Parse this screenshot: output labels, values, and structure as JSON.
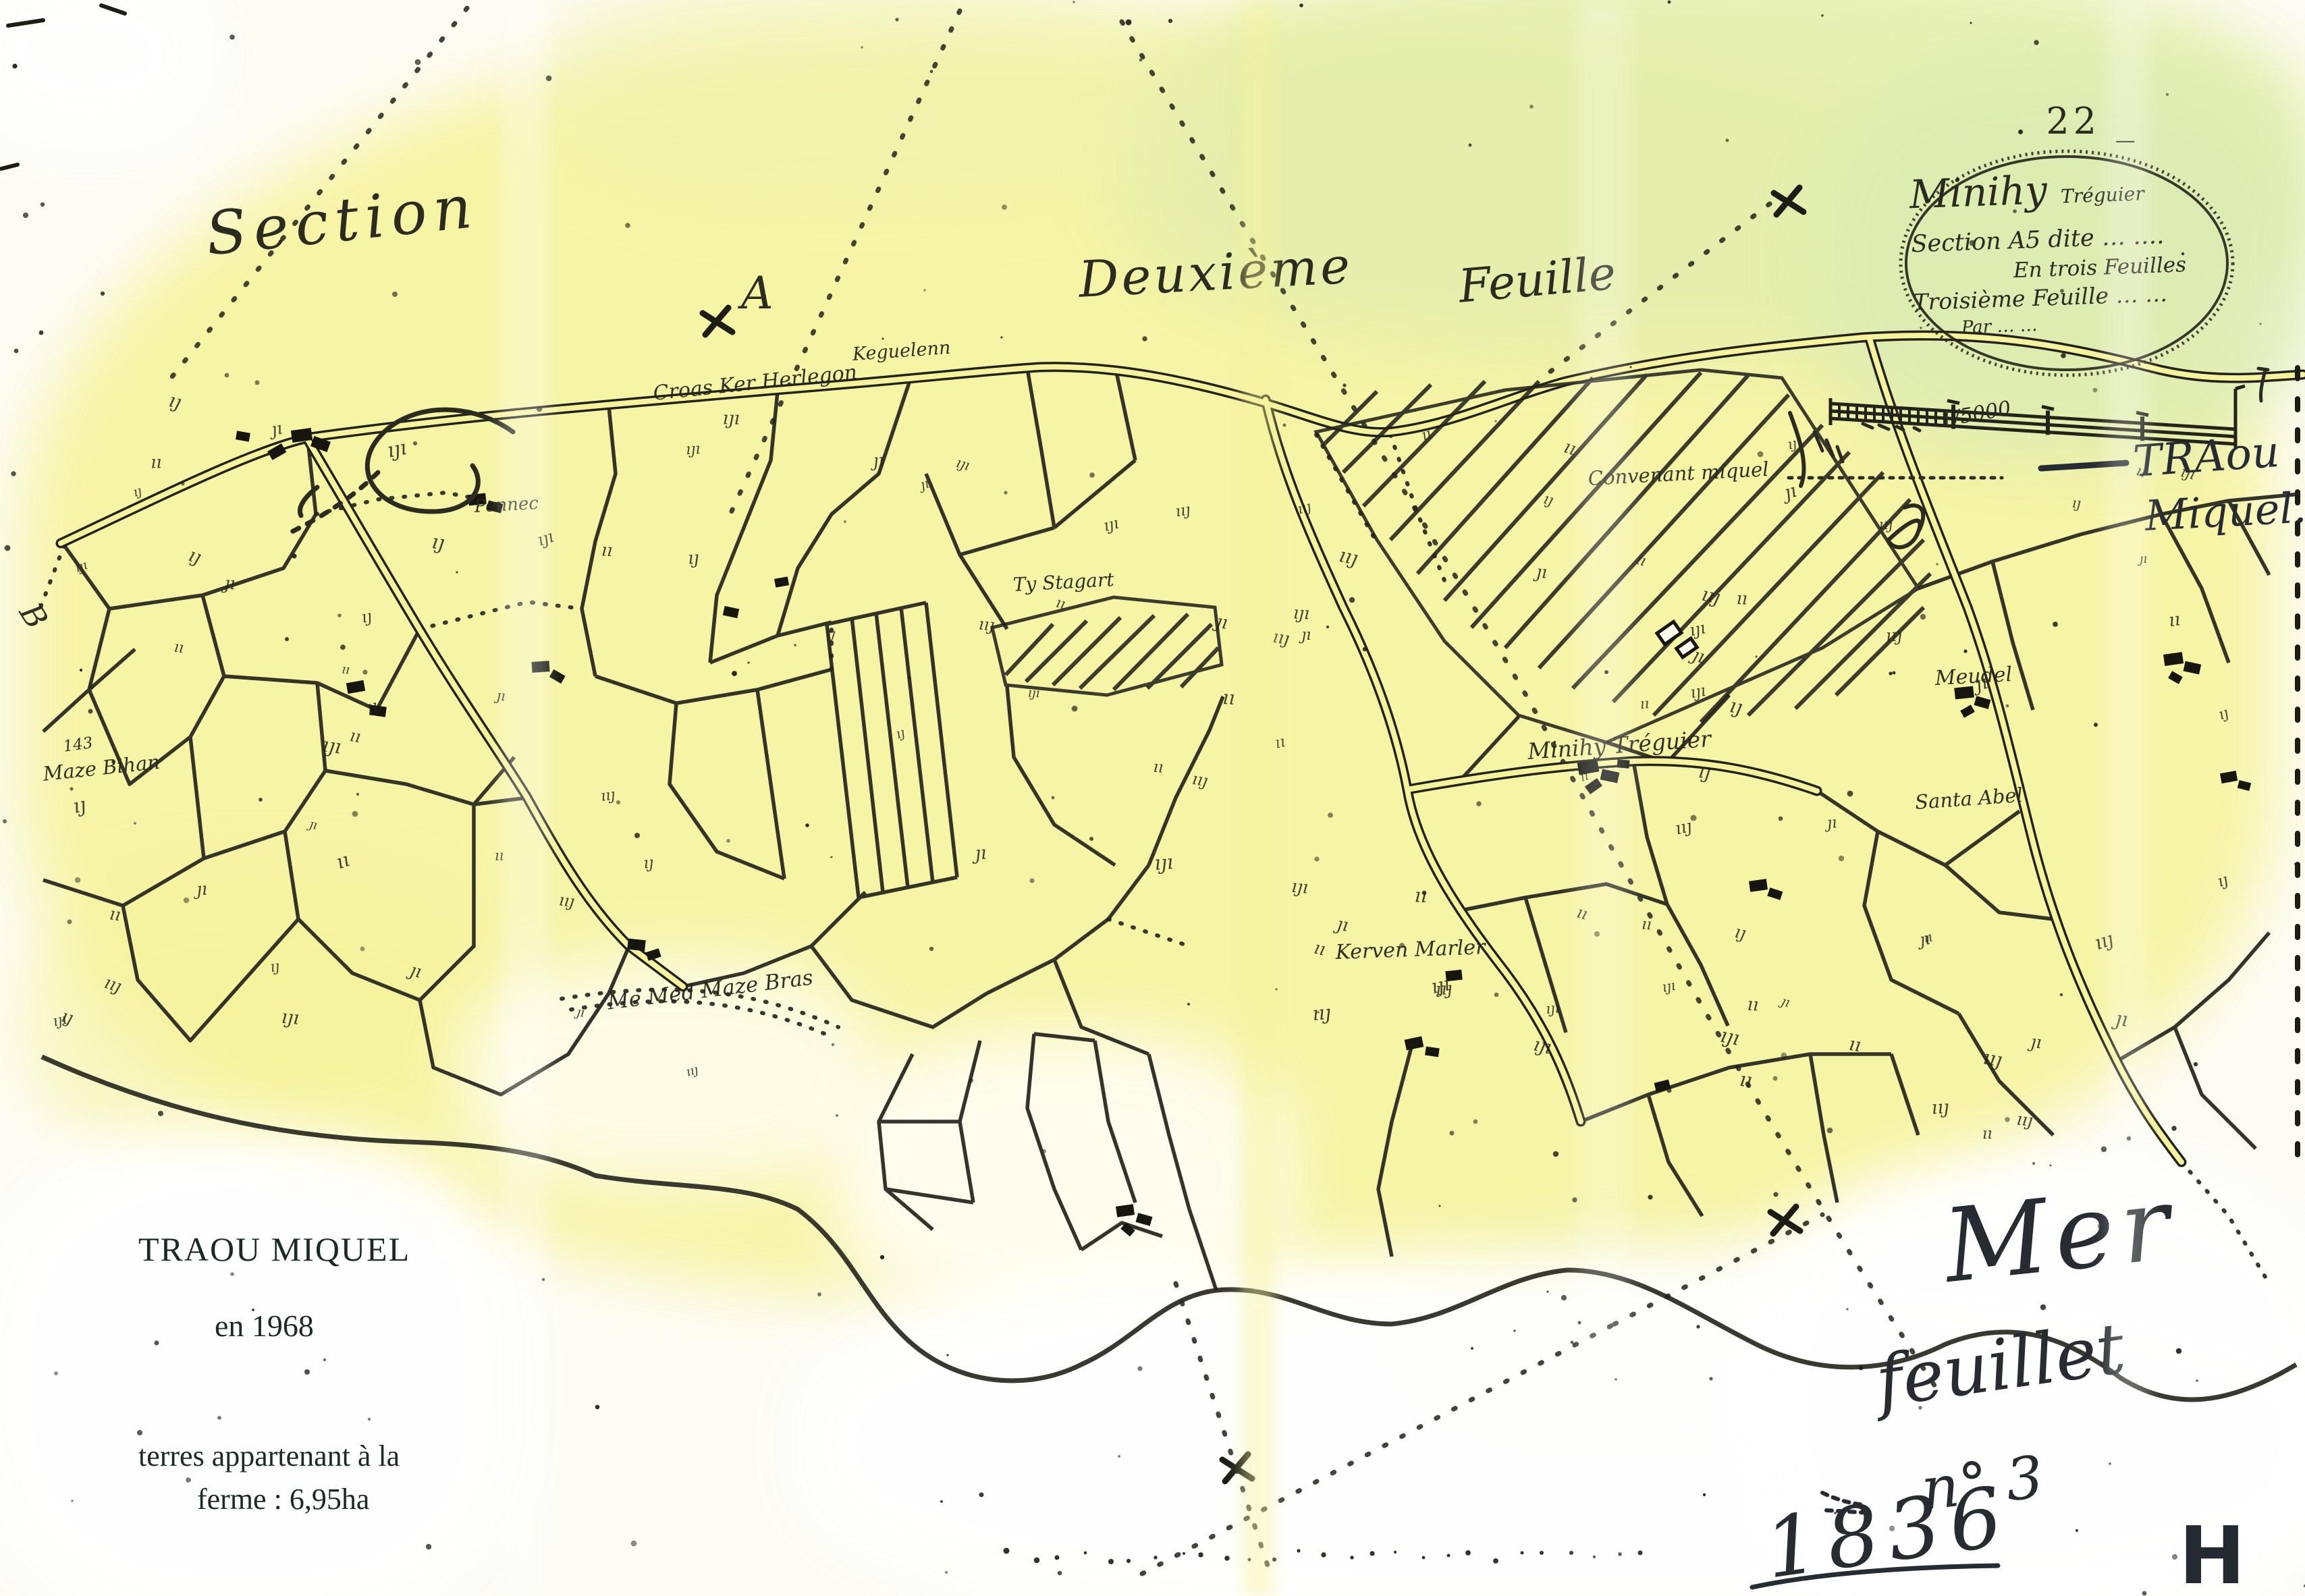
{
  "colors": {
    "paper_white": "#fcfcf4",
    "wash_yellow": "#f6f39b",
    "wash_green": "#dfecb0",
    "map_ink": "#23231a",
    "pen_ink": "#262c31",
    "caption_ink": "#1b2a22"
  },
  "header": {
    "sheet_number": ". 22 _",
    "section_script": "Section",
    "letter": "A",
    "deuxieme_script": "Deuxième",
    "feuille_script": "Feuille"
  },
  "cartouche": {
    "title": "Minihy",
    "title_suffix": "Tréguier",
    "line2": "Section A5 dite … ….",
    "line3": "En trois Feuilles",
    "line4": "Troisième Feuille … …",
    "line5": "Par …  …"
  },
  "scale_bar": {
    "fraction": "1/5000"
  },
  "pen_annotations": {
    "traou_line1": "TRAou",
    "traou_line2": "Miquel.",
    "mer": "Mer",
    "feuillet": "feuillet",
    "numero": "n° 3",
    "year": "1836",
    "corner_letter": "H"
  },
  "caption": {
    "title": "TRAOU  MIQUEL",
    "date_line": "en  1968",
    "note_line1": "terres appartenant à la",
    "note_line2": "ferme :  6,95ha"
  },
  "map_labels": [
    {
      "text": "Croas Ker Herlegon"
    },
    {
      "text": "Keguelenn"
    },
    {
      "text": "Ty Stagart"
    },
    {
      "text": "Convenant miquel"
    },
    {
      "text": "Minihy Tréguier"
    },
    {
      "text": "Kerven Marler"
    },
    {
      "text": "Me Med Maze Bras"
    },
    {
      "text": "Maze Bihan"
    },
    {
      "text": "143"
    },
    {
      "text": "Meudel"
    },
    {
      "text": "Santa Abel"
    },
    {
      "text": "Pennec"
    },
    {
      "text": "B"
    }
  ]
}
